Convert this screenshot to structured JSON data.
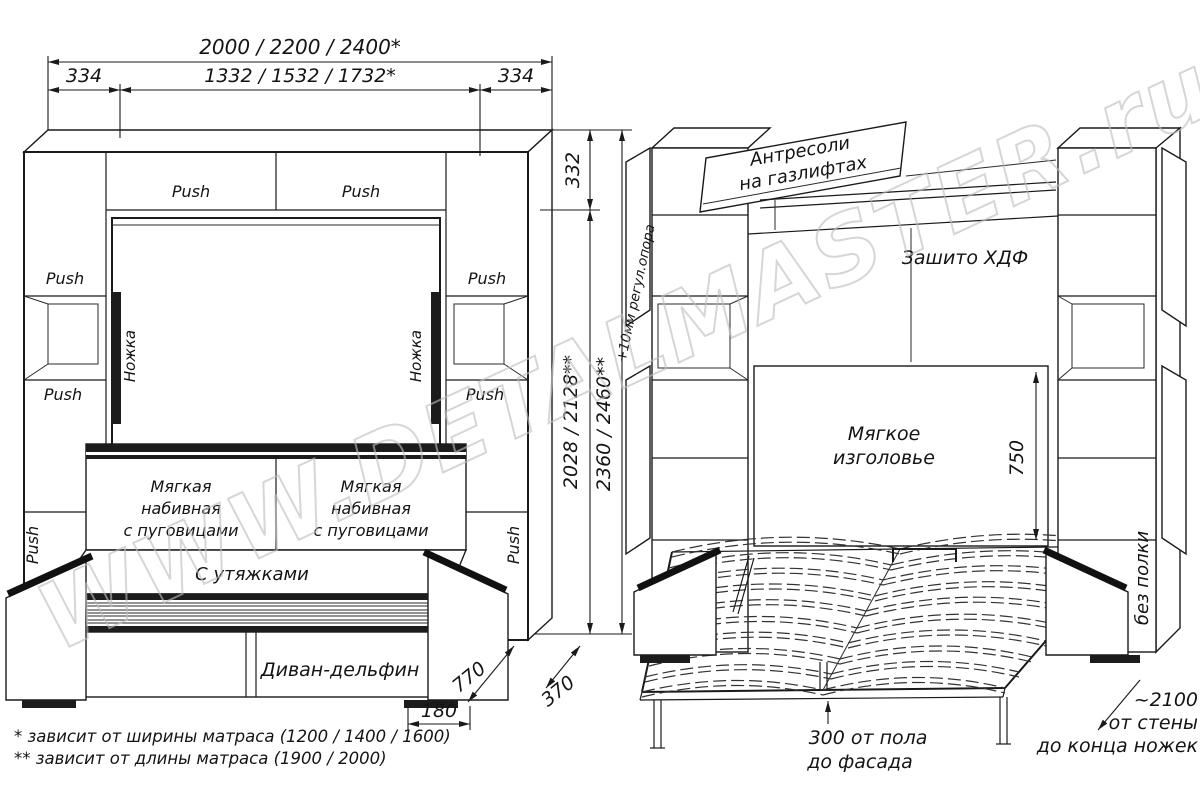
{
  "watermark": "WWW.DETALMASTER.ru",
  "footnotes": {
    "width_note": "* зависит от ширины матраса (1200 / 1400 / 1600)",
    "length_note": "** зависит от длины матраса (1900 / 2000)"
  },
  "closed_view": {
    "dims": {
      "total_width": "2000 / 2200 / 2400*",
      "side_width_left": "334",
      "inner_width": "1332 / 1532 / 1732*",
      "side_width_right": "334",
      "top_section_height": "332",
      "inner_height": "2028 / 2128**",
      "total_height": "2360 / 2460**",
      "support_note": "+10мм регул.опора",
      "sofa_depth": "770",
      "cabinet_depth": "370",
      "foot_offset": "180"
    },
    "labels": {
      "push": "Push",
      "fold_leg": "Ножка",
      "cushion_line1": "Мягкая",
      "cushion_line2": "набивная",
      "cushion_line3": "с пуговицами",
      "seat": "С утяжками",
      "base": "Диван-дельфин"
    }
  },
  "open_view": {
    "dims": {
      "headboard_height": "750"
    },
    "labels": {
      "top_cabinet_line1": "Антресоли",
      "top_cabinet_line2": "на газлифтах",
      "back_panel": "Зашито ХДФ",
      "headboard_line1": "Мягкое",
      "headboard_line2": "изголовье",
      "no_shelf": "без полки",
      "floor_clearance_line1": "300 от пола",
      "floor_clearance_line2": "до фасада",
      "wall_distance_line1": "~2100",
      "wall_distance_line2": "от стены",
      "wall_distance_line3": "до конца ножек"
    }
  }
}
